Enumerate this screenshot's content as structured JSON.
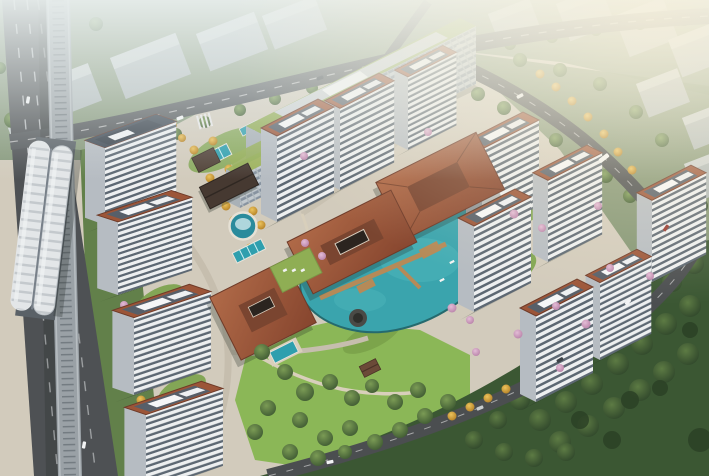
{
  "scene": {
    "type": "aerial-architectural-rendering",
    "subject": "bird's-eye rendering of a residential compound beside an elevated metro line, with white slab towers, terracotta-roof clubhouse pavilions, a turquoise landscape lake, pools, autumn trees, a central lawn park and a forest belt",
    "regions": [
      "hazy-background-city",
      "elevated-metro-station",
      "metro-viaduct",
      "arterial-road-left",
      "arterial-road-top",
      "perimeter-road-right",
      "office-building-green-roof",
      "residential-towers",
      "clubhouse-pavilions",
      "landscape-lake",
      "wooden-piers",
      "lap-pools",
      "fountain-plaza",
      "central-park-lawn",
      "forest-belt",
      "autumn-tree-rows",
      "blossom-trees"
    ],
    "tower_count": 13,
    "pavilion_count": 4,
    "lighting": "soft daylight, warm sun glow from upper right, mist haze over background city"
  },
  "palette": {
    "haze": "#e9efee",
    "bg_building_front": "#b7bfc3",
    "bg_building_top": "#d4dadc",
    "bg_field": "#87997c",
    "tree_green": "#4a6b3c",
    "forest_green": "#3b5733",
    "lawn_green": "#7aa24a",
    "park_green": "#8bb757",
    "gold_tree": "#d9a43a",
    "blossom_pink": "#cfa0c2",
    "water_teal": "#2f9fae",
    "lake_teal": "#3aa4ad",
    "roof_terracotta": "#9c5538",
    "roof_ridge": "#6e3a28",
    "roof_panel": "#575f69",
    "facade_white": "#edeff0",
    "facade_window": "#5d6873",
    "green_roof": "#93ad56",
    "asphalt": "#4e5154",
    "road_line": "#d8d8d8",
    "pier_wood": "#b58a58",
    "station_roof": "#e3e6e8",
    "hardscape": "#d2cbbc"
  }
}
